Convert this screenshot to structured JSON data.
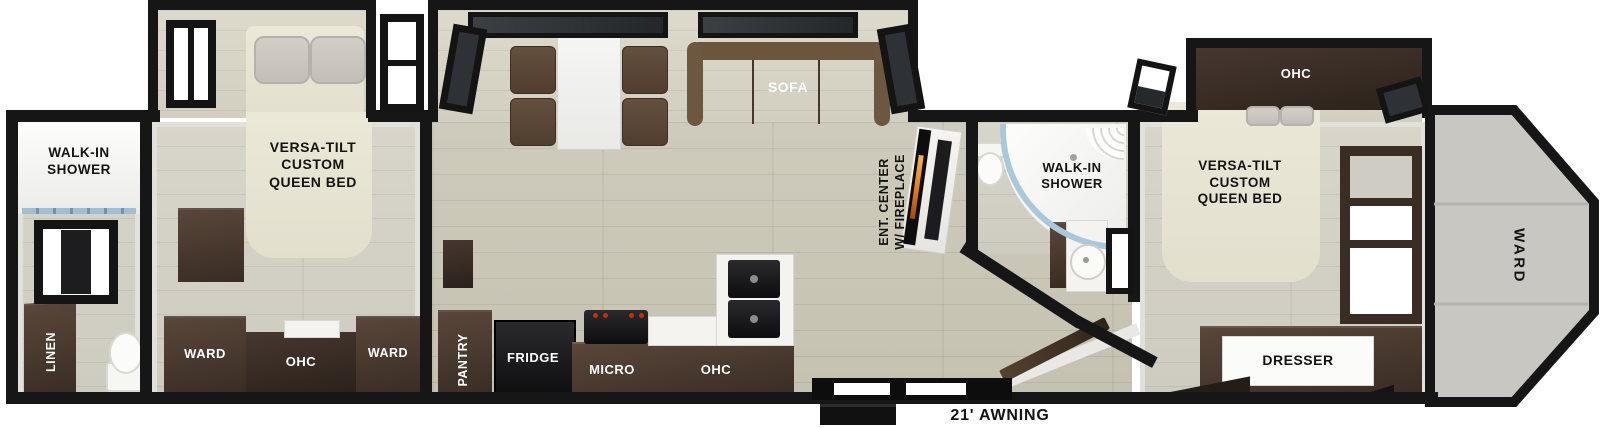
{
  "floorplan": {
    "awning": "21' AWNING",
    "rear_bath": {
      "shower": "WALK-IN\nSHOWER",
      "linen": "LINEN"
    },
    "rear_bedroom": {
      "bed": "VERSA-TILT\nCUSTOM\nQUEEN BED",
      "ward_left": "WARD",
      "ohc": "OHC",
      "ward_right": "WARD"
    },
    "living": {
      "sofa": "SOFA",
      "ent_center": "ENT. CENTER\nW/ FIREPLACE"
    },
    "kitchen": {
      "pantry": "PANTRY",
      "fridge": "FRIDGE",
      "micro": "MICRO",
      "ohc": "OHC"
    },
    "mid_bath": {
      "shower": "WALK-IN\nSHOWER"
    },
    "front_bedroom": {
      "ohc": "OHC",
      "bed": "VERSA-TILT\nCUSTOM\nQUEEN BED",
      "dresser": "DRESSER"
    },
    "front_cap": {
      "ward": "WARD"
    },
    "colors": {
      "wall": "#161616",
      "cabinet": "#4a3a30",
      "flame": "#e8821e",
      "shower_glass": "#a9c8db"
    }
  }
}
